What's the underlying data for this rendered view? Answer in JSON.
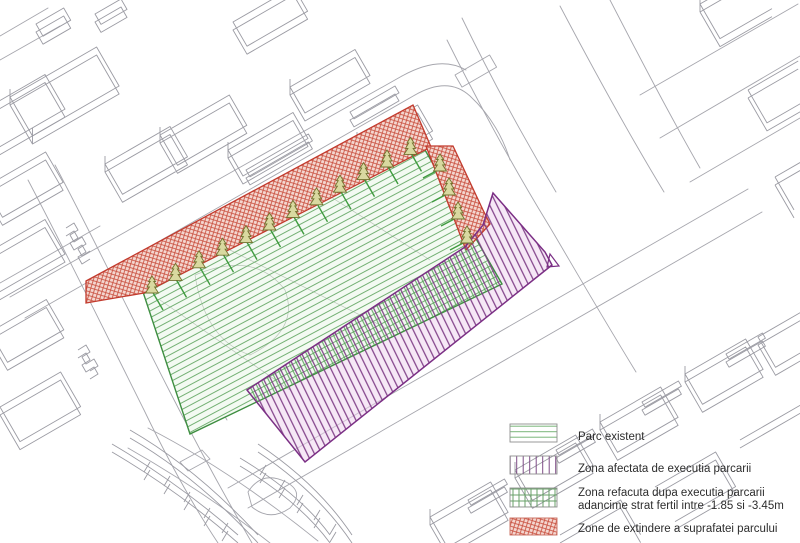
{
  "drawing": {
    "type": "axonometric-site-plan",
    "zones": [
      {
        "id": "park-existing",
        "legend_label": "Parc existent",
        "hatch": "green-diagonal-lines"
      },
      {
        "id": "parking-affected-zone",
        "legend_label": "Zona afectata de executia parcarii",
        "hatch": "purple-steep-lines"
      },
      {
        "id": "restored-zone-overlap",
        "legend_label": "Zona refacuta dupa executia parcarii",
        "hatch": "green-crosshatch-with-purple"
      },
      {
        "id": "park-extension-strips",
        "legend_label": "Zone de extindere a suprafatei parcului",
        "hatch": "red-dense-crosshatch"
      }
    ],
    "trees": {
      "top_strip_count": 12,
      "right_strip_count": 4,
      "symbol": "conifer-tree-icon"
    }
  },
  "legend": {
    "items": [
      {
        "label": "Parc existent",
        "pattern": "green-horizontal-lines"
      },
      {
        "label": "Zona afectata de executia parcarii",
        "pattern": "purple-vertical-lines"
      },
      {
        "label": "Zona refacuta dupa executia parcarii",
        "label_line2": "adancime strat fertil intre -1.85 si -3.45m",
        "pattern": "green-grid"
      },
      {
        "label": "Zone de extindere a suprafatei parcului",
        "pattern": "red-crosshatch"
      }
    ]
  },
  "colors": {
    "park_hatch_green": "#74b074",
    "park_border_green": "#3e8e41",
    "park_fill": "#f3faf2",
    "purple_hatch": "#7e3d86",
    "purple_border": "#7b2f85",
    "purple_tint": "#eed6ee",
    "red_hatch": "#c94f3e",
    "red_fill": "#f4d7d0",
    "red_border": "#c23b2e",
    "tree_stem_green": "#3f9b3f",
    "tree_outline_olive": "#72722f",
    "tree_fill": "#d9d9a0",
    "wireframe_gray": "#9b9ba3",
    "street_gray": "#a6a6ad",
    "legend_text": "#2d2d2d"
  }
}
